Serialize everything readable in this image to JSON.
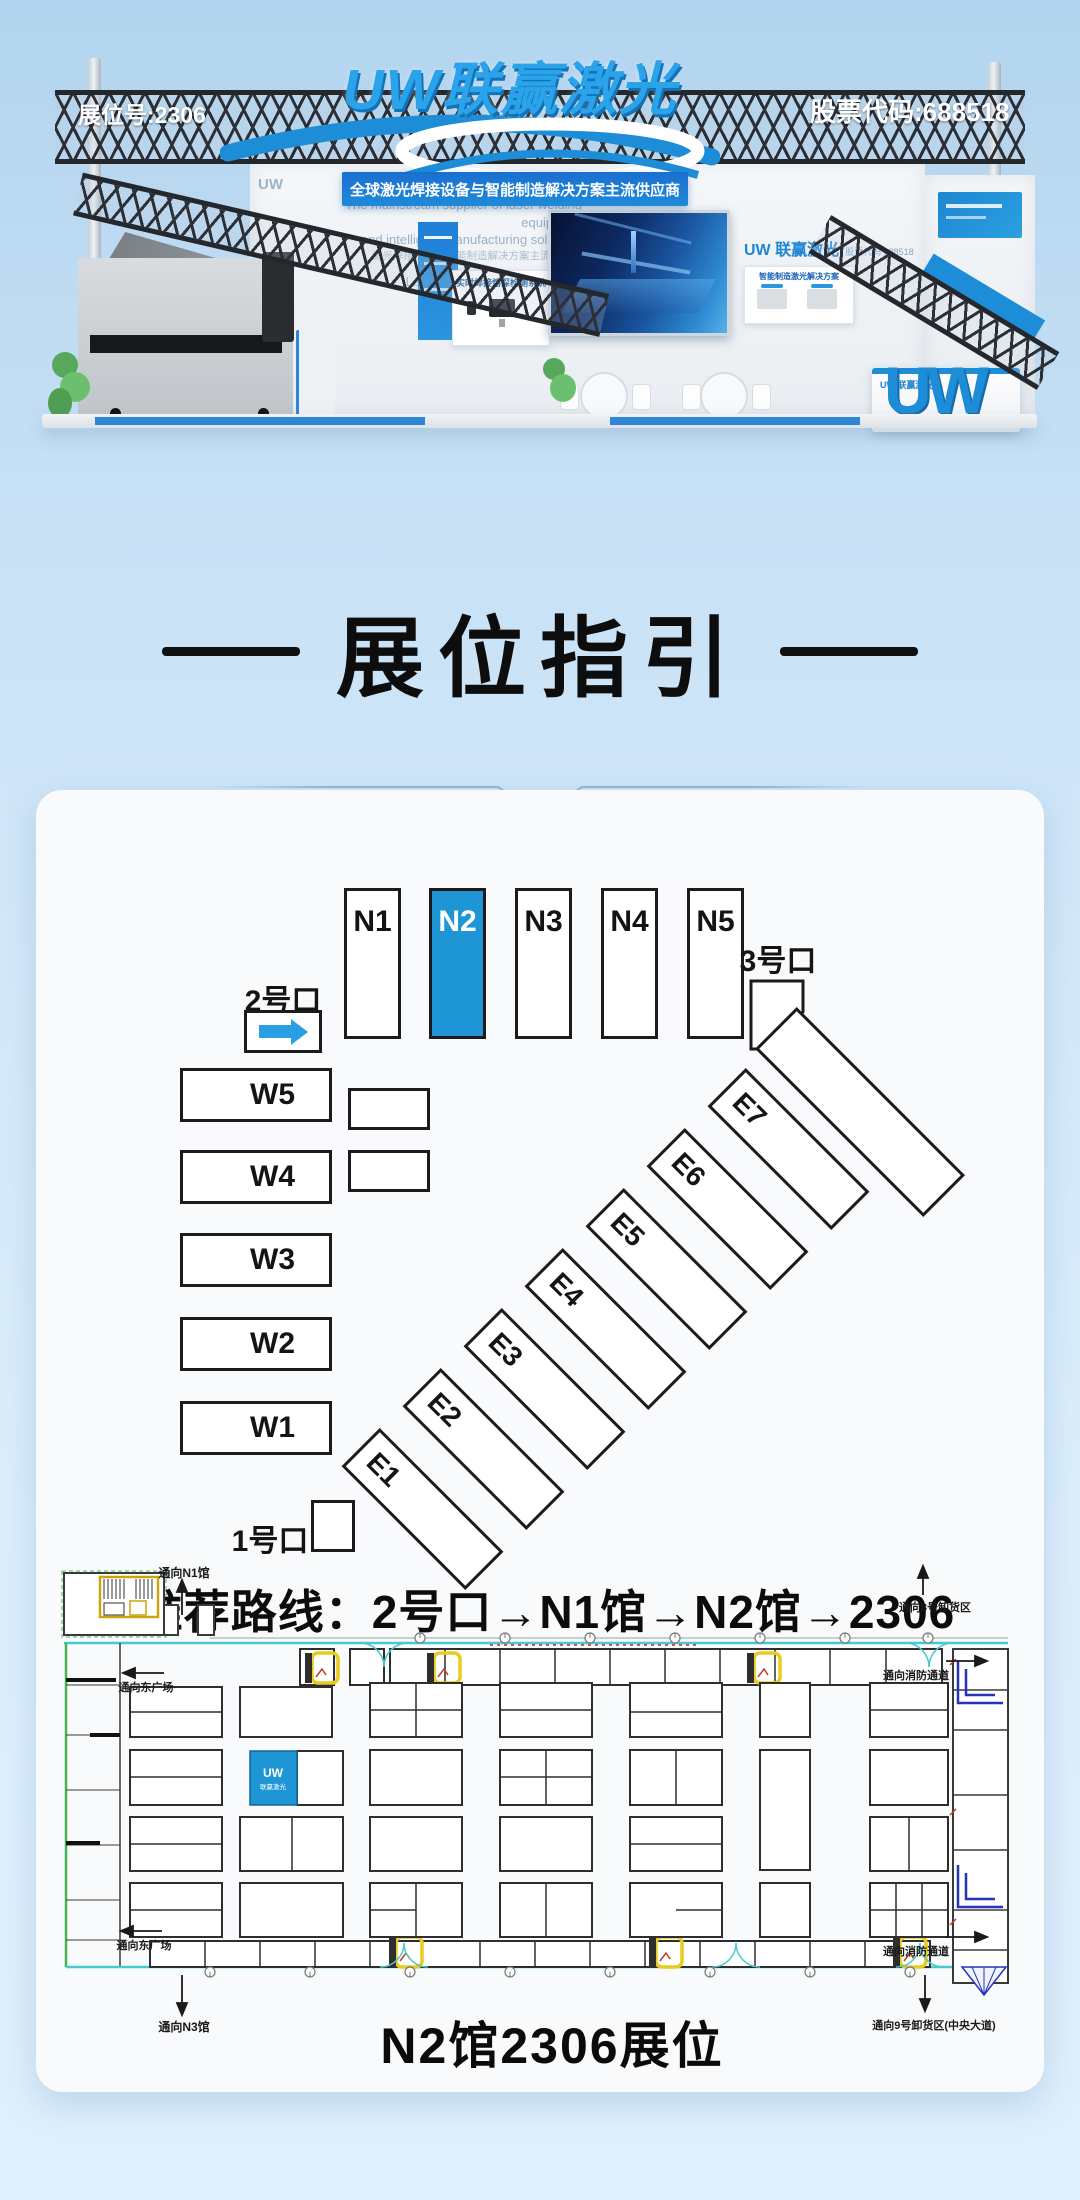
{
  "colors": {
    "accent_blue": "#1e96d5",
    "brand_blue": "#1e8dd8",
    "banner_blue": "#1a6fd0",
    "sky": "#b2d4ee"
  },
  "hero": {
    "booth_no": "展位号:2306",
    "stock_code": "股票代码:688518",
    "logo": "UW联赢激光",
    "slogan": "全球激光焊接设备与智能制造解决方案主流供应商",
    "wall_en1": "The mainstream supplier of laser welding equipment",
    "wall_en2": "and intelligent manufacturing solutions",
    "wall_cn1": "激光焊接设备与智能制造解决方案主流供应商",
    "wall_en3": "Leading brand in laser welding",
    "wall_cn2": "激光焊接领军品牌",
    "small_logo": "UW",
    "inner_logo": "UW 联赢激光",
    "inner_stock": "股票代码 688518",
    "poster_title": "智能制造激光解决方案",
    "board_title": "实时焊接熔深检测系统",
    "counter_logo": "UW 联赢激光",
    "uw_letters": "UW"
  },
  "section": {
    "title": "展位指引"
  },
  "map": {
    "north_halls": [
      {
        "label": "N1"
      },
      {
        "label": "N2"
      },
      {
        "label": "N3"
      },
      {
        "label": "N4"
      },
      {
        "label": "N5"
      }
    ],
    "west_halls": [
      "W5",
      "W4",
      "W3",
      "W2",
      "W1"
    ],
    "east_halls": [
      "E1",
      "E2",
      "E3",
      "E4",
      "E5",
      "E6",
      "E7"
    ],
    "gate1": "1号口",
    "gate2": "2号口",
    "gate3": "3号口",
    "route": "推荐路线：2号口→N1馆→N2馆→2306"
  },
  "floorplan": {
    "dir_n1": "通向N1馆",
    "dir_unload8": "通向8号卸货区",
    "dir_plaza_top": "通向东广场",
    "dir_fire_top": "通向消防通道",
    "dir_plaza_bottom": "通向东广场",
    "dir_n3": "通向N3馆",
    "dir_fire_bottom": "通向消防通道",
    "dir_unload9": "通向9号卸货区(中央大道)",
    "booth_logo": "UW",
    "booth_logo_sub": "联赢激光",
    "caption": "N2馆2306展位"
  }
}
